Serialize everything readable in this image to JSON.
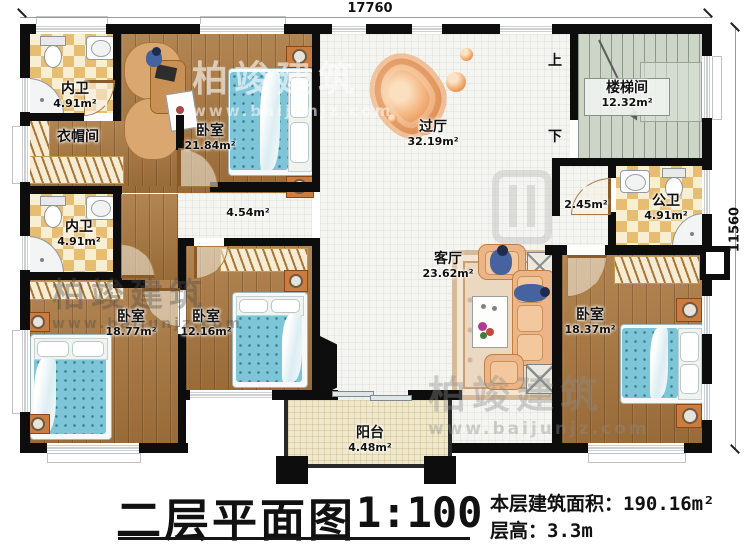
{
  "dimensions": {
    "top": "17760",
    "right": "11560"
  },
  "title_block": {
    "plan_title": "二层平面图",
    "scale": "1:100",
    "area_label": "本层建筑面积：",
    "area_value": "190.16m²",
    "height_label": "层高：",
    "height_value": "3.3m"
  },
  "stairs": {
    "up": "上",
    "down": "下"
  },
  "watermark": {
    "brand": "柏竣建筑",
    "site": "www.baijunjz.com"
  },
  "rooms": {
    "bath_top": {
      "name": "内卫",
      "area": "4.91m²"
    },
    "bedroom_top": {
      "name": "卧室",
      "area": "21.84m²"
    },
    "cloakroom": {
      "name": "衣帽间"
    },
    "hall": {
      "name": "过厅",
      "area": "32.19m²"
    },
    "stairwell": {
      "name": "楼梯间",
      "area": "12.32m²"
    },
    "bath_mid": {
      "name": "内卫",
      "area": "4.91m²"
    },
    "corridor": {
      "area": "4.54m²"
    },
    "corridor_east": {
      "area": "2.45m²"
    },
    "bath_public": {
      "name": "公卫",
      "area": "4.91m²"
    },
    "living": {
      "name": "客厅",
      "area": "23.62m²"
    },
    "bedroom_sw": {
      "name": "卧室",
      "area": "18.77m²"
    },
    "bedroom_s": {
      "name": "卧室",
      "area": "12.16m²"
    },
    "bedroom_se": {
      "name": "卧室",
      "area": "18.37m²"
    },
    "balcony": {
      "name": "阳台",
      "area": "4.48m²"
    }
  }
}
